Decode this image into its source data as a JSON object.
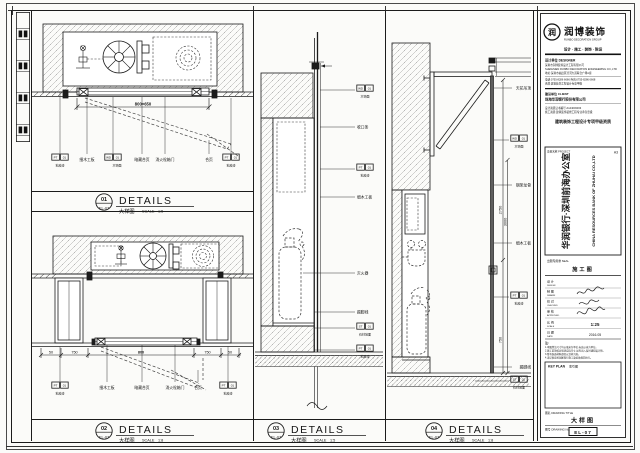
{
  "sheet": {
    "details": [
      {
        "num": "01",
        "ref": "EL-07",
        "title": "DETAILS",
        "cn": "大样图",
        "scale_word": "SCALE",
        "scale": "1:5"
      },
      {
        "num": "02",
        "ref": "EL-07",
        "title": "DETAILS",
        "cn": "大样图",
        "scale_word": "SCALE",
        "scale": "1:8"
      },
      {
        "num": "03",
        "ref": "EL-07",
        "title": "DETAILS",
        "cn": "大样图",
        "scale_word": "SCALE",
        "scale": "1:5"
      },
      {
        "num": "04",
        "ref": "EL-07",
        "title": "DETAILS",
        "cn": "大样图",
        "scale_word": "SCALE",
        "scale": "1:8"
      }
    ]
  },
  "p1": {
    "dim": "800×650",
    "tag0": {
      "a": "PT",
      "b": "01",
      "cap": "乳胶漆"
    },
    "txt1": "细木工板",
    "tag2": {
      "a": "WD",
      "b": "01",
      "cap": "木饰面"
    },
    "txt3": "暗藏合页",
    "txt4": "消火栓箱门",
    "txt5": "合页",
    "tag6": {
      "a": "PT",
      "b": "01",
      "cap": "乳胶漆"
    }
  },
  "p2": {
    "dims": [
      "50",
      "750",
      "800",
      "750",
      "50"
    ],
    "tag0": {
      "a": "PT",
      "b": "01",
      "cap": "乳胶漆"
    },
    "txt1": "细木工板",
    "txt2": "暗藏合页",
    "txt3": "消火栓箱门",
    "txt4": "合页",
    "tag5": {
      "a": "PT",
      "b": "01",
      "cap": "乳胶漆"
    }
  },
  "p3": {
    "tag0": {
      "a": "WD",
      "b": "01",
      "cap": "木饰面"
    },
    "txt1": "收口条",
    "tag2": {
      "a": "PT",
      "b": "01",
      "cap": "乳胶漆"
    },
    "txt3": "细木工板",
    "txt4": "灭火器",
    "txt5": "踢脚线",
    "tag6": {
      "a": "ST",
      "b": "01",
      "cap": "石材地面"
    },
    "tag7": {
      "a": "PT",
      "b": "01",
      "cap": "乳胶漆"
    }
  },
  "p4": {
    "txt0": "天花吊顶",
    "tag1": {
      "a": "WD",
      "b": "01",
      "cap": "木饰面"
    },
    "txt2": "钢架龙骨",
    "txt3": "细木工板",
    "tag4": {
      "a": "PT",
      "b": "01",
      "cap": "乳胶漆"
    },
    "txt5": "踢脚线",
    "tag6": {
      "a": "ST",
      "b": "01",
      "cap": "石材地面"
    },
    "dim1": "2750",
    "dim2": "3000",
    "dim3": "750"
  },
  "titleblock": {
    "logo": {
      "mark": "润",
      "name": "润博装饰",
      "en": "RUNBO DECORATION GROUP",
      "tagline": "设计 · 施工 · 装饰 · 陈设"
    },
    "company": {
      "header": "设计单位 DESIGNER",
      "lines": [
        "深圳市润博装饰设计工程有限公司",
        "SHENZHEN RUNBO DECORATION ENGINEERING CO.,LTD",
        "地址:深圳市福田区滨河大道联合广场A座",
        "电话:0755-8286 6666  传真:0755-8286 6668",
        "资质:建筑装饰工程设计专项甲级"
      ]
    },
    "client": {
      "label": "建设单位 CLIENT",
      "value": "珠海华润银行股份有限公司"
    },
    "lic1": "设计资质证书编号:A144003333",
    "lic2": "施工资质:建筑装饰装修工程专业承包壹级",
    "cert": "建筑装饰工程设计专项甲级资质",
    "project": {
      "label": "项目名称 PROJECT",
      "grade": "A3",
      "cn": "华润银行·深圳前海办公室",
      "en": "CHINA RESOURCES BANK OF ZHUHAI CO.,LTD"
    },
    "stage": {
      "label": "出图专用章 SEAL",
      "value": "施工图"
    },
    "sigs": [
      {
        "cn": "设 计",
        "en": "DESIGN"
      },
      {
        "cn": "制 图",
        "en": "DRAWN"
      },
      {
        "cn": "校 对",
        "en": "CHECKED"
      },
      {
        "cn": "审 核",
        "en": "APPROVED"
      }
    ],
    "scale_row": {
      "cn": "比 例",
      "en": "SCALE",
      "value": "1:25"
    },
    "date_row": {
      "cn": "日 期",
      "en": "DATE",
      "value": "2016.05"
    },
    "notes": {
      "header": "注:",
      "lines": [
        "1.本图所注尺寸均以毫米为单位,标高以米为单位。",
        "2.施工前须核对现场实际尺寸,如有出入及时通知设计师。",
        "3.所有饰面材料颜色以封样为准。",
        "4.未尽事宜按国家现行施工及验收规范执行。"
      ]
    },
    "keyplan": {
      "en": "KEY PLAN",
      "cn": "索引图"
    },
    "title_row": {
      "label": "图名 DRAWING TITLE",
      "value": "大样图"
    },
    "no_row": {
      "label": "图号 DRAWING No.",
      "value": "EL-07"
    }
  }
}
